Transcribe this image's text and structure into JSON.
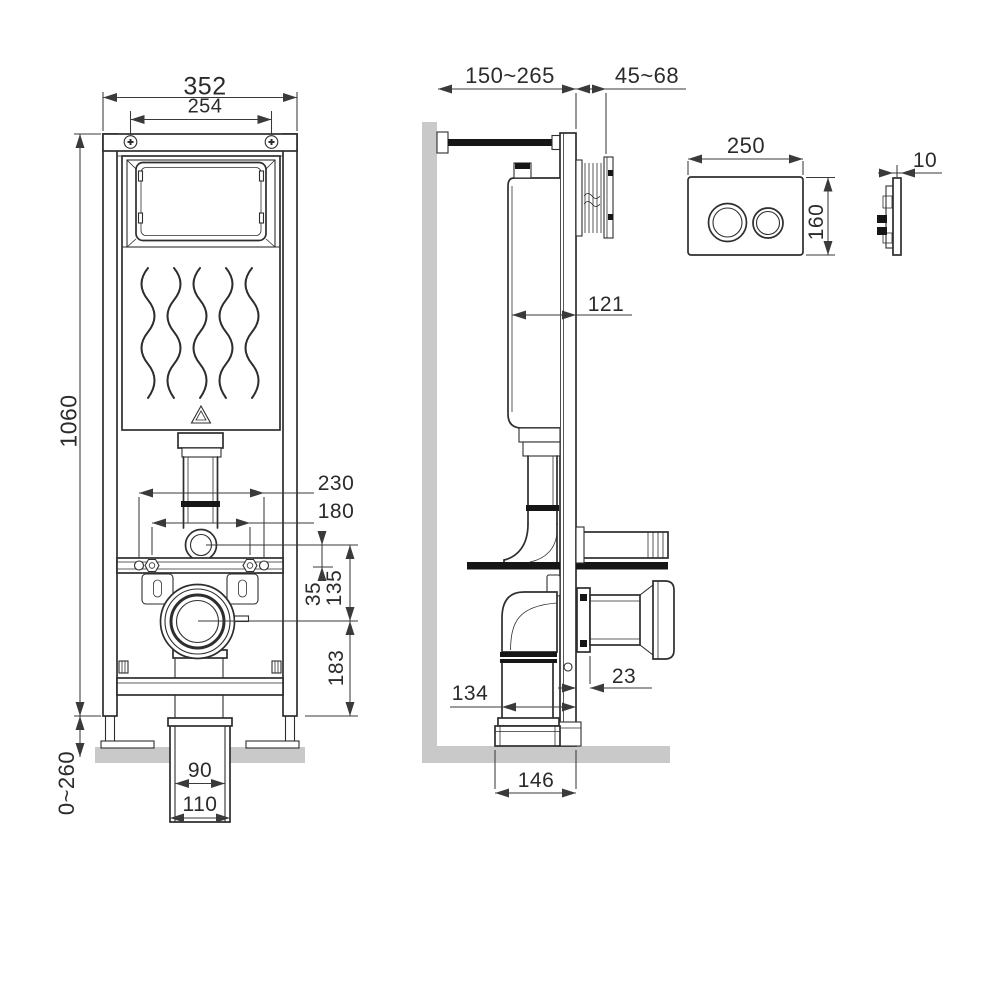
{
  "front_view": {
    "dims": {
      "overall_width": "352",
      "top_bolt_spacing": "254",
      "frame_height": "1060",
      "leg_adjust_range": "0~260",
      "fixing_spacing_outer": "230",
      "fixing_spacing_inner": "180",
      "inlet_offset": "35",
      "inlet_to_outlet": "135",
      "outlet_to_floor": "183",
      "drain_inner_dia": "90",
      "drain_outer_dia": "110"
    }
  },
  "side_view": {
    "dims": {
      "frame_depth_range": "150~265",
      "finish_depth_range": "45~68",
      "cistern_depth": "121",
      "outlet_flange_offset": "23",
      "drain_center_offset": "134",
      "base_depth": "146"
    }
  },
  "flush_plate": {
    "dims": {
      "width": "250",
      "height": "160",
      "thickness": "10"
    }
  },
  "colors": {
    "line": "#2e2e2e",
    "dimension_line": "#3a3a3a",
    "wall_floor_gray": "#c9c9c9",
    "solid_black": "#161616"
  }
}
